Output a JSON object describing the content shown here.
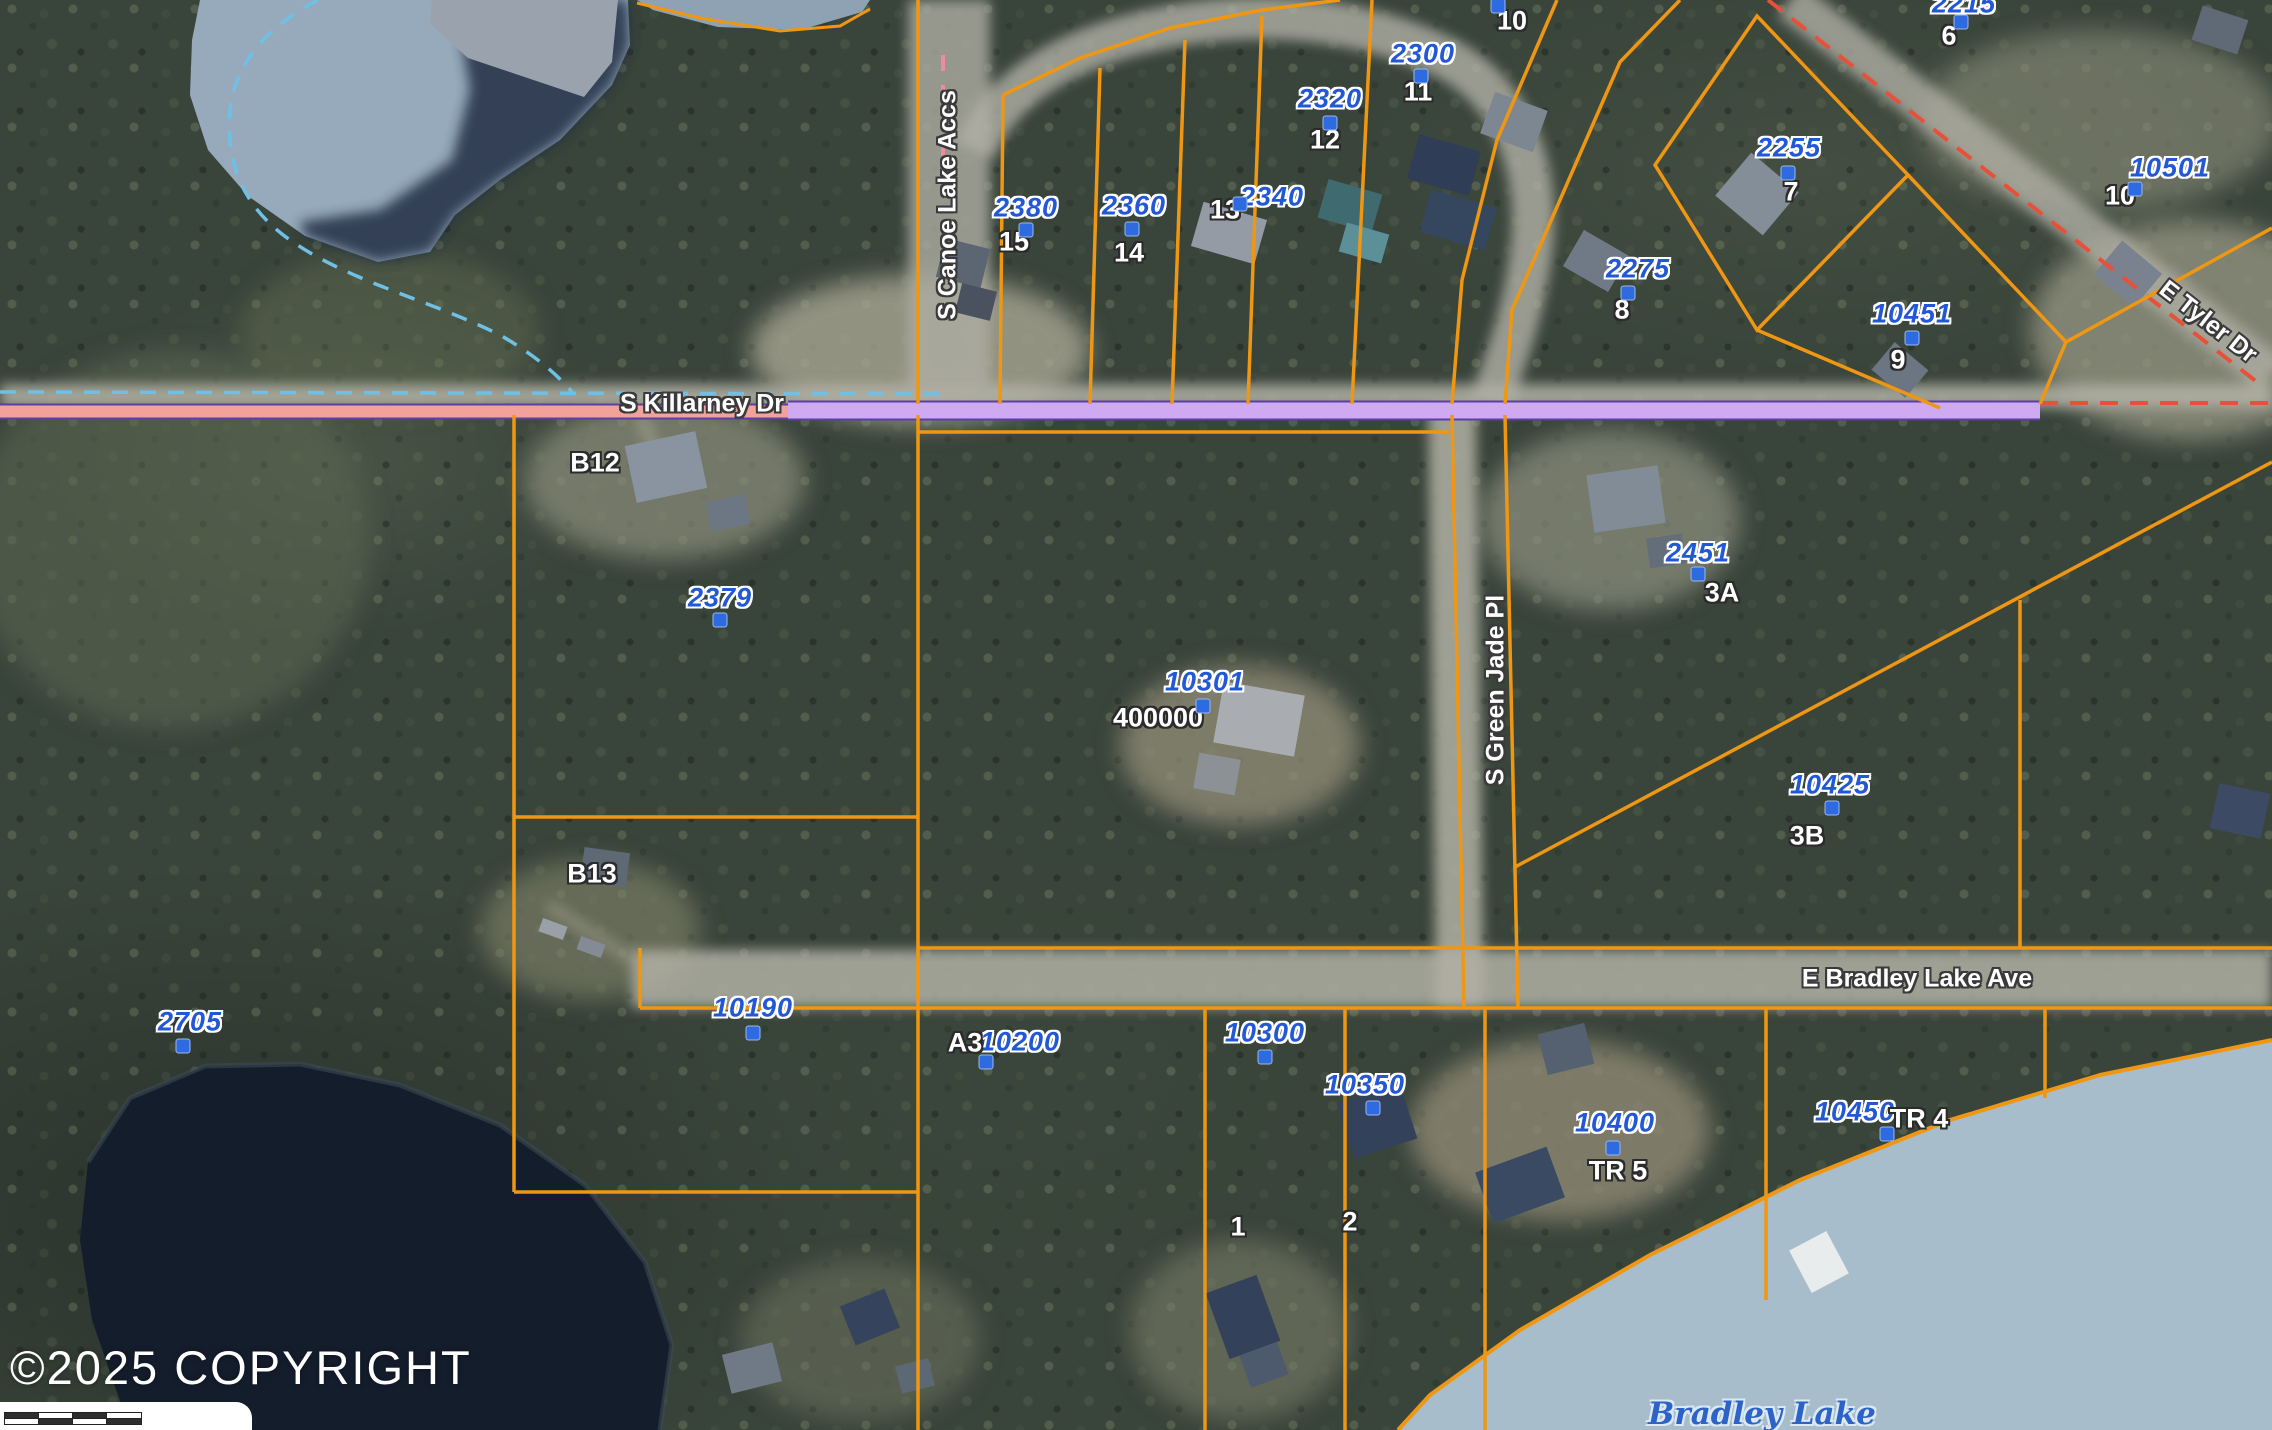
{
  "meta": {
    "copyright": "©2025 COPYRIGHT"
  },
  "colors": {
    "parcel_line": "#ef9712",
    "address_label": "#2257d6",
    "parcel_dot": "#2f6be0",
    "water_light": "#96aabb",
    "water_shadow": "#232f44",
    "water_dark_lake": "#141d2c",
    "bradley_water": "#a7bdcb",
    "section_pink": "#f2a29b",
    "section_lavender": "#cfaaf2",
    "section_purple": "#5b3fa6",
    "road_gray": "#b1b0a5",
    "stream_blue": "#6fc0e4",
    "red_dash": "#e8503a"
  },
  "map": {
    "streets": [
      {
        "text": "S Killarney Dr",
        "x": 702,
        "y": 404,
        "rot": 0
      },
      {
        "text": "S Canoe Lake Accs",
        "x": 948,
        "y": 205,
        "rot": -90
      },
      {
        "text": "S Green Jade Pl",
        "x": 1496,
        "y": 690,
        "rot": -90
      },
      {
        "text": "E Bradley Lake Ave",
        "x": 1917,
        "y": 979,
        "rot": 0
      },
      {
        "text": "E Tyler Dr",
        "x": 2208,
        "y": 322,
        "rot": 38
      }
    ],
    "addresses": [
      {
        "text": "2380",
        "x": 1026,
        "y": 208
      },
      {
        "text": "2360",
        "x": 1134,
        "y": 206
      },
      {
        "text": "2340",
        "x": 1272,
        "y": 197
      },
      {
        "text": "2320",
        "x": 1330,
        "y": 99
      },
      {
        "text": "2300",
        "x": 1423,
        "y": 54
      },
      {
        "text": "2215",
        "x": 1964,
        "y": 4
      },
      {
        "text": "2275",
        "x": 1638,
        "y": 269
      },
      {
        "text": "2255",
        "x": 1789,
        "y": 148
      },
      {
        "text": "10501",
        "x": 2170,
        "y": 168
      },
      {
        "text": "10451",
        "x": 1912,
        "y": 314
      },
      {
        "text": "2451",
        "x": 1698,
        "y": 553
      },
      {
        "text": "10425",
        "x": 1830,
        "y": 785
      },
      {
        "text": "2379",
        "x": 720,
        "y": 598
      },
      {
        "text": "10301",
        "x": 1205,
        "y": 682
      },
      {
        "text": "10190",
        "x": 753,
        "y": 1008
      },
      {
        "text": "2705",
        "x": 190,
        "y": 1022
      },
      {
        "text": "10200",
        "x": 1020,
        "y": 1042
      },
      {
        "text": "10300",
        "x": 1265,
        "y": 1033
      },
      {
        "text": "10350",
        "x": 1365,
        "y": 1085
      },
      {
        "text": "10400",
        "x": 1615,
        "y": 1123
      },
      {
        "text": "10450",
        "x": 1855,
        "y": 1112
      }
    ],
    "lot_numbers": [
      {
        "text": "15",
        "x": 1014,
        "y": 242
      },
      {
        "text": "14",
        "x": 1129,
        "y": 253
      },
      {
        "text": "13",
        "x": 1225,
        "y": 210
      },
      {
        "text": "12",
        "x": 1325,
        "y": 140
      },
      {
        "text": "11",
        "x": 1418,
        "y": 92
      },
      {
        "text": "10",
        "x": 1512,
        "y": 21
      },
      {
        "text": "6",
        "x": 1949,
        "y": 36
      },
      {
        "text": "7",
        "x": 1791,
        "y": 192
      },
      {
        "text": "8",
        "x": 1622,
        "y": 310
      },
      {
        "text": "9",
        "x": 1898,
        "y": 360
      },
      {
        "text": "10",
        "x": 2120,
        "y": 196
      },
      {
        "text": "3A",
        "x": 1722,
        "y": 593
      },
      {
        "text": "3B",
        "x": 1807,
        "y": 836
      },
      {
        "text": "A3",
        "x": 965,
        "y": 1043
      },
      {
        "text": "1",
        "x": 1238,
        "y": 1227
      },
      {
        "text": "2",
        "x": 1350,
        "y": 1222
      },
      {
        "text": "TR 5",
        "x": 1618,
        "y": 1171
      },
      {
        "text": "TR 4",
        "x": 1919,
        "y": 1119
      },
      {
        "text": "400000",
        "x": 1158,
        "y": 718
      },
      {
        "text": "B12",
        "x": 595,
        "y": 463
      },
      {
        "text": "B13",
        "x": 592,
        "y": 874
      }
    ],
    "water_labels": [
      {
        "text": "Bradley Lake",
        "x": 1762,
        "y": 1414
      }
    ],
    "dots": [
      {
        "x": 1026,
        "y": 230
      },
      {
        "x": 1132,
        "y": 229
      },
      {
        "x": 1240,
        "y": 204
      },
      {
        "x": 1330,
        "y": 123
      },
      {
        "x": 1421,
        "y": 76
      },
      {
        "x": 1498,
        "y": 6
      },
      {
        "x": 1961,
        "y": 22
      },
      {
        "x": 1628,
        "y": 293
      },
      {
        "x": 1788,
        "y": 173
      },
      {
        "x": 2135,
        "y": 189
      },
      {
        "x": 1912,
        "y": 338
      },
      {
        "x": 1698,
        "y": 574
      },
      {
        "x": 1832,
        "y": 808
      },
      {
        "x": 720,
        "y": 620
      },
      {
        "x": 1203,
        "y": 706
      },
      {
        "x": 753,
        "y": 1033
      },
      {
        "x": 183,
        "y": 1046
      },
      {
        "x": 986,
        "y": 1062
      },
      {
        "x": 1265,
        "y": 1057
      },
      {
        "x": 1373,
        "y": 1108
      },
      {
        "x": 1613,
        "y": 1148
      },
      {
        "x": 1887,
        "y": 1134
      }
    ]
  }
}
